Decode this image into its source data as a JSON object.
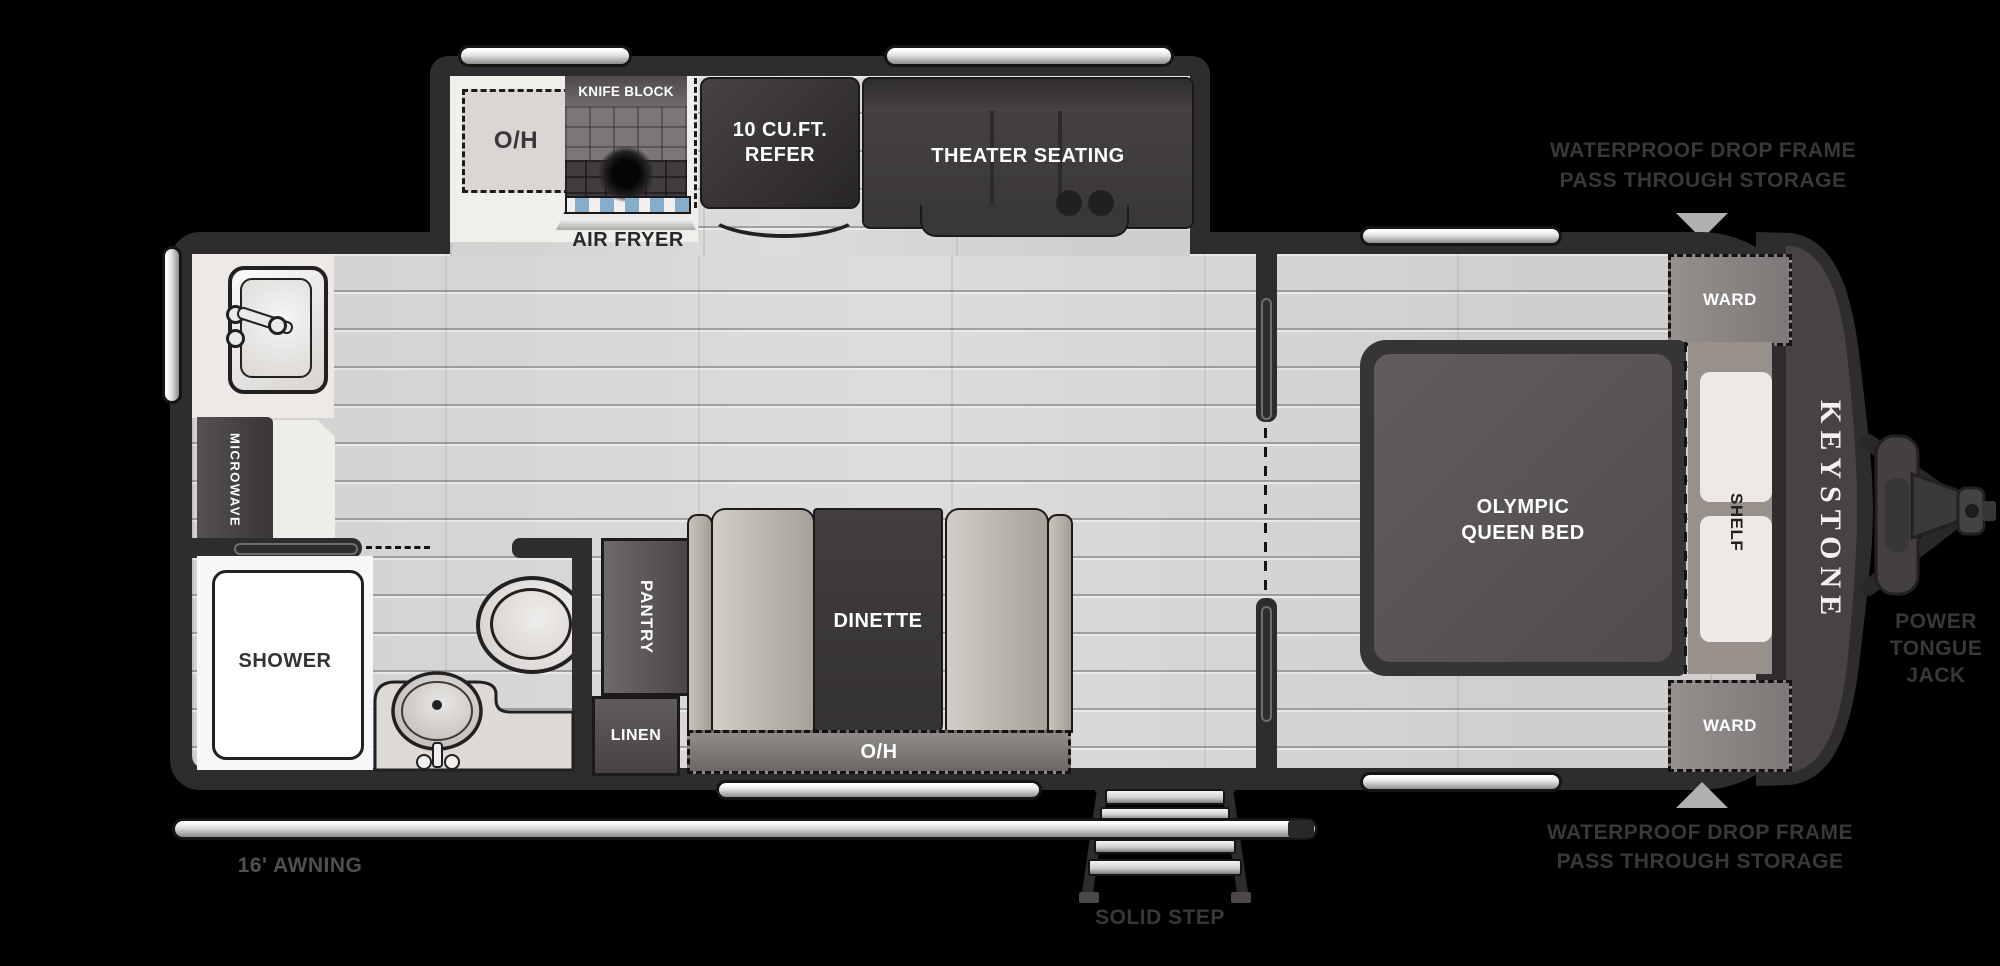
{
  "floorplan": {
    "brand": "KEYSTONE",
    "kitchen_slide": {
      "overhead": "O/H",
      "knife_block": "KNIFE BLOCK",
      "air_fryer": "AIR FRYER",
      "refrigerator": "10 CU.FT. REFER",
      "theater": "THEATER SEATING"
    },
    "galley": {
      "microwave": "MICROWAVE",
      "pantry": "PANTRY",
      "linen": "LINEN"
    },
    "bathroom": {
      "shower": "SHOWER"
    },
    "dinette": {
      "label": "DINETTE",
      "overhead": "O/H"
    },
    "bedroom": {
      "bed": "OLYMPIC QUEEN BED",
      "shelf": "SHELF",
      "ward_top": "WARD",
      "ward_bottom": "WARD"
    },
    "exterior": {
      "awning": "16' AWNING",
      "solid_step": "SOLID STEP",
      "storage_top": "WATERPROOF DROP FRAME PASS THROUGH STORAGE",
      "storage_bottom": "WATERPROOF DROP FRAME PASS THROUGH STORAGE",
      "tongue_jack": "POWER TONGUE JACK"
    },
    "colors": {
      "background": "#000000",
      "wall": "#2e2c2e",
      "floor": "#dbdad8",
      "annotation_text": "#3a3738",
      "pointer_triangle": "#b2afb0"
    }
  }
}
